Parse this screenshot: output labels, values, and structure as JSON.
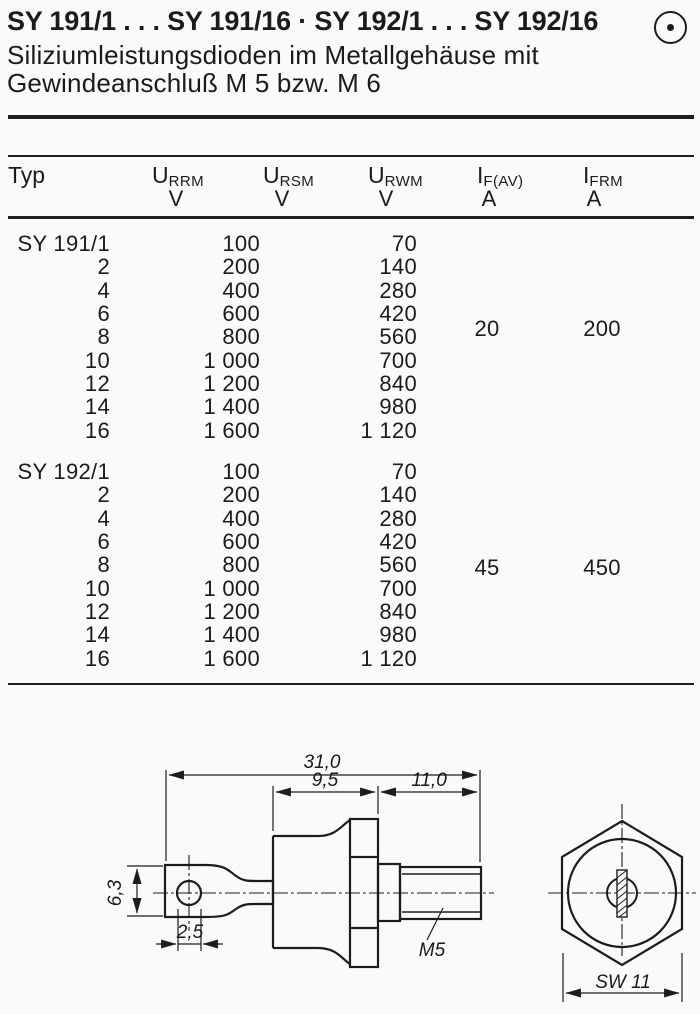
{
  "header": {
    "title": "SY 191/1 . . . SY 191/16 · SY 192/1 . . . SY 192/16",
    "subtitle_line1": "Siliziumleistungsdioden im Metallgehäuse mit",
    "subtitle_line2": "Gewindeanschluß M 5 bzw. M 6",
    "corner_icon": "circled-dot"
  },
  "table": {
    "col_typ": "Typ",
    "cols": [
      {
        "sym": "U",
        "sub": "RRM",
        "unit": "V"
      },
      {
        "sym": "U",
        "sub": "RSM",
        "unit": "V"
      },
      {
        "sym": "U",
        "sub": "RWM",
        "unit": "V"
      },
      {
        "sym": "I",
        "sub": "F(AV)",
        "unit": "A"
      },
      {
        "sym": "I",
        "sub": "FRM",
        "unit": "A"
      }
    ],
    "sections": [
      {
        "if_av": "20",
        "ifrm": "200",
        "rows": [
          {
            "typ": "SY 191/1",
            "urrm": "100",
            "urwm": "70"
          },
          {
            "typ": "2",
            "urrm": "200",
            "urwm": "140"
          },
          {
            "typ": "4",
            "urrm": "400",
            "urwm": "280"
          },
          {
            "typ": "6",
            "urrm": "600",
            "urwm": "420"
          },
          {
            "typ": "8",
            "urrm": "800",
            "urwm": "560"
          },
          {
            "typ": "10",
            "urrm": "1 000",
            "urwm": "700"
          },
          {
            "typ": "12",
            "urrm": "1 200",
            "urwm": "840"
          },
          {
            "typ": "14",
            "urrm": "1 400",
            "urwm": "980"
          },
          {
            "typ": "16",
            "urrm": "1 600",
            "urwm": "1 120"
          }
        ]
      },
      {
        "if_av": "45",
        "ifrm": "450",
        "rows": [
          {
            "typ": "SY 192/1",
            "urrm": "100",
            "urwm": "70"
          },
          {
            "typ": "2",
            "urrm": "200",
            "urwm": "140"
          },
          {
            "typ": "4",
            "urrm": "400",
            "urwm": "280"
          },
          {
            "typ": "6",
            "urrm": "600",
            "urwm": "420"
          },
          {
            "typ": "8",
            "urrm": "800",
            "urwm": "560"
          },
          {
            "typ": "10",
            "urrm": "1 000",
            "urwm": "700"
          },
          {
            "typ": "12",
            "urrm": "1 200",
            "urwm": "840"
          },
          {
            "typ": "14",
            "urrm": "1 400",
            "urwm": "980"
          },
          {
            "typ": "16",
            "urrm": "1 600",
            "urwm": "1 120"
          }
        ]
      }
    ]
  },
  "drawing": {
    "dim_total": "31,0",
    "dim_case": "9,5",
    "dim_stud": "11,0",
    "dim_lug": "6,3",
    "dim_hole": "2,5",
    "thread_label": "M5",
    "wrench_label": "SW 11",
    "ink_color": "#1c1c1c",
    "paper_color": "#fafaf8"
  }
}
